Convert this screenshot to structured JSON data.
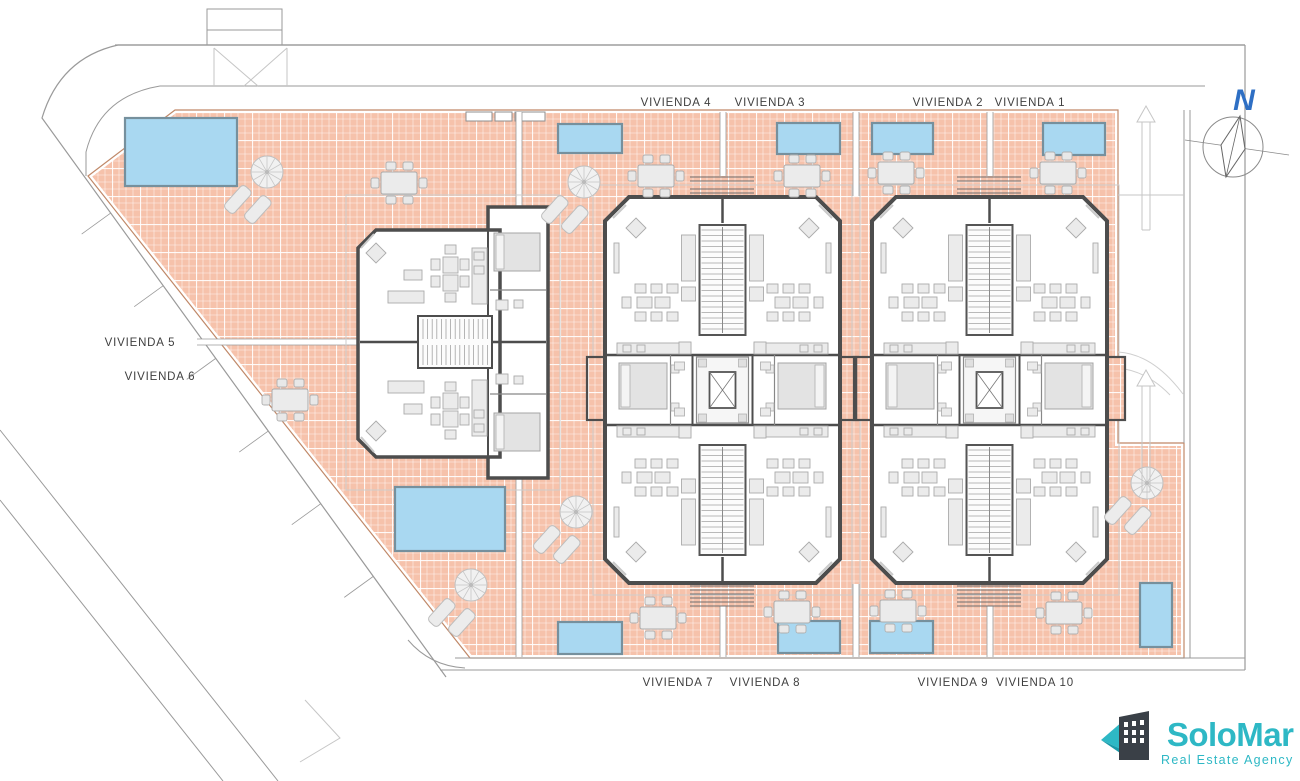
{
  "colors": {
    "tile": "#f6c2ab",
    "plot_edge": "#c08868",
    "pool_fill": "#a9d8f1",
    "pool_edge": "#76909d",
    "wall": "#4d4d4d",
    "furniture_fill": "#ebebeb",
    "furniture_edge": "#ababab",
    "street": "#9a9a9a",
    "street_light": "#c6c6c6",
    "label_text": "#3f3f3f",
    "logo_teal": "#2eb8c5",
    "logo_teal_dark": "#1a99a8",
    "logo_building": "#3a4047",
    "compass_blue": "#2e6fc4"
  },
  "site": {
    "plot_polygon": [
      [
        175,
        110
      ],
      [
        1118,
        110
      ],
      [
        1118,
        443
      ],
      [
        1184,
        443
      ],
      [
        1184,
        658
      ],
      [
        470,
        658
      ],
      [
        88,
        176
      ]
    ]
  },
  "unit_labels": [
    {
      "text": "VIVIENDA 4",
      "x": 676,
      "y": 106
    },
    {
      "text": "VIVIENDA 3",
      "x": 770,
      "y": 106
    },
    {
      "text": "VIVIENDA 2",
      "x": 948,
      "y": 106
    },
    {
      "text": "VIVIENDA 1",
      "x": 1030,
      "y": 106
    },
    {
      "text": "VIVIENDA 5",
      "x": 140,
      "y": 346
    },
    {
      "text": "VIVIENDA 6",
      "x": 160,
      "y": 380
    },
    {
      "text": "VIVIENDA 7",
      "x": 678,
      "y": 686
    },
    {
      "text": "VIVIENDA 8",
      "x": 765,
      "y": 686
    },
    {
      "text": "VIVIENDA 9",
      "x": 953,
      "y": 686
    },
    {
      "text": "VIVIENDA 10",
      "x": 1035,
      "y": 686
    }
  ],
  "compass": {
    "label": "N"
  },
  "logo": {
    "name": "SoloMar",
    "tagline": "Real Estate Agency"
  },
  "pools": [
    {
      "x": 125,
      "y": 118,
      "w": 112,
      "h": 68
    },
    {
      "x": 558,
      "y": 124,
      "w": 64,
      "h": 29
    },
    {
      "x": 777,
      "y": 123,
      "w": 63,
      "h": 31
    },
    {
      "x": 872,
      "y": 123,
      "w": 61,
      "h": 31
    },
    {
      "x": 1043,
      "y": 123,
      "w": 62,
      "h": 32
    },
    {
      "x": 395,
      "y": 487,
      "w": 110,
      "h": 64
    },
    {
      "x": 558,
      "y": 622,
      "w": 64,
      "h": 32
    },
    {
      "x": 778,
      "y": 621,
      "w": 62,
      "h": 32
    },
    {
      "x": 870,
      "y": 621,
      "w": 63,
      "h": 32
    },
    {
      "x": 1140,
      "y": 583,
      "w": 32,
      "h": 64
    }
  ],
  "parasols": [
    {
      "x": 267,
      "y": 172
    },
    {
      "x": 584,
      "y": 182
    },
    {
      "x": 576,
      "y": 512
    },
    {
      "x": 471,
      "y": 585
    },
    {
      "x": 1147,
      "y": 483
    }
  ],
  "dining_tables": [
    {
      "x": 399,
      "y": 183
    },
    {
      "x": 656,
      "y": 176
    },
    {
      "x": 802,
      "y": 176
    },
    {
      "x": 896,
      "y": 173
    },
    {
      "x": 1058,
      "y": 173
    },
    {
      "x": 290,
      "y": 400
    },
    {
      "x": 658,
      "y": 618
    },
    {
      "x": 792,
      "y": 612
    },
    {
      "x": 898,
      "y": 611
    },
    {
      "x": 1064,
      "y": 613
    }
  ],
  "buildings": {
    "duplex": {
      "x": 358,
      "y": 207,
      "w": 190,
      "h": 271
    },
    "quad_blocks": [
      {
        "x": 605,
        "y": 197,
        "w": 235,
        "h": 386
      },
      {
        "x": 872,
        "y": 197,
        "w": 235,
        "h": 386
      }
    ]
  },
  "walkways": [
    {
      "o": "v",
      "x": 519,
      "y1": 112,
      "y2": 206
    },
    {
      "o": "v",
      "x": 519,
      "y1": 479,
      "y2": 657
    },
    {
      "o": "v",
      "x": 723,
      "y1": 112,
      "y2": 176
    },
    {
      "o": "v",
      "x": 723,
      "y1": 606,
      "y2": 657
    },
    {
      "o": "v",
      "x": 856,
      "y1": 112,
      "y2": 196
    },
    {
      "o": "v",
      "x": 856,
      "y1": 584,
      "y2": 657
    },
    {
      "o": "v",
      "x": 990,
      "y1": 112,
      "y2": 176
    },
    {
      "o": "v",
      "x": 990,
      "y1": 606,
      "y2": 657
    },
    {
      "o": "h",
      "y": 342,
      "x1": 197,
      "x2": 358
    }
  ],
  "exterior_stairs": [
    {
      "x": 722,
      "y": 177
    },
    {
      "x": 989,
      "y": 177
    },
    {
      "x": 722,
      "y": 586
    },
    {
      "x": 989,
      "y": 586
    }
  ],
  "driveway_arrows": [
    {
      "x": 1146,
      "y_tail": 230,
      "y_head": 106
    },
    {
      "x": 1146,
      "y_tail": 492,
      "y_head": 370
    }
  ]
}
